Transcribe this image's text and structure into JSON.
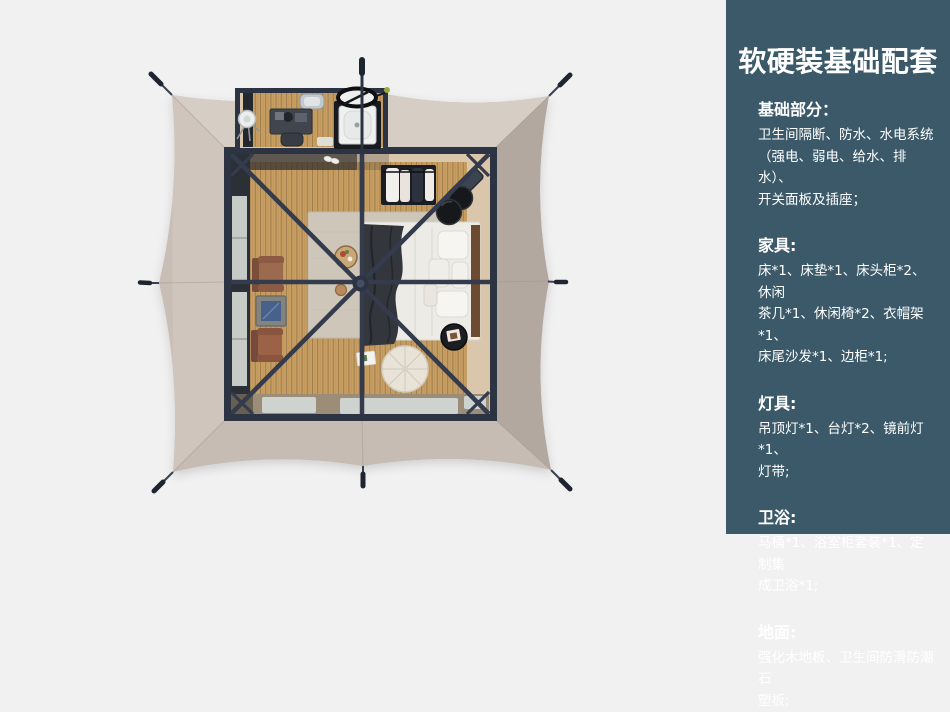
{
  "panel": {
    "bg_color": "#3b5968",
    "text_color": "#ffffff",
    "title": "软硬装基础配套",
    "sections": [
      {
        "heading": "基础部分：",
        "body": "卫生间隔断、防水、水电系统\n（强电、弱电、给水、排水）、\n开关面板及插座；"
      },
      {
        "heading": "家具:",
        "body": "床*1、床垫*1、床头柜*2、休闲\n茶几*1、休闲椅*2、衣帽架*1、\n床尾沙发*1、边柜*1;"
      },
      {
        "heading": "灯具:",
        "body": "吊顶灯*1、台灯*2、镜前灯*1、\n灯带;"
      },
      {
        "heading": "卫浴:",
        "body": "马桶*1、浴室柜套装*1、定制集\n成卫浴*1;"
      },
      {
        "heading": "地面:",
        "body": "强化木地板、卫生间防滑防潮石\n塑板;"
      }
    ]
  },
  "scene": {
    "colors": {
      "page_bg": "#f1f1f2",
      "canvas": "#c8beb5",
      "canvas_top": "#d6cdc4",
      "canvas_left": "#cfc5bc",
      "canvas_right": "#b3a8a0",
      "canvas_bottom": "#c6bcb4",
      "frame": "#2c3342",
      "beam": "#333b4d",
      "wood": "#c89f63",
      "floor_beige": "#d9c6ab",
      "rug": "#cdc6b9",
      "bed": "#ecebe6",
      "blanket": "#33373d",
      "chair": "#9c6a4e",
      "window": "#c6cbc8"
    }
  }
}
